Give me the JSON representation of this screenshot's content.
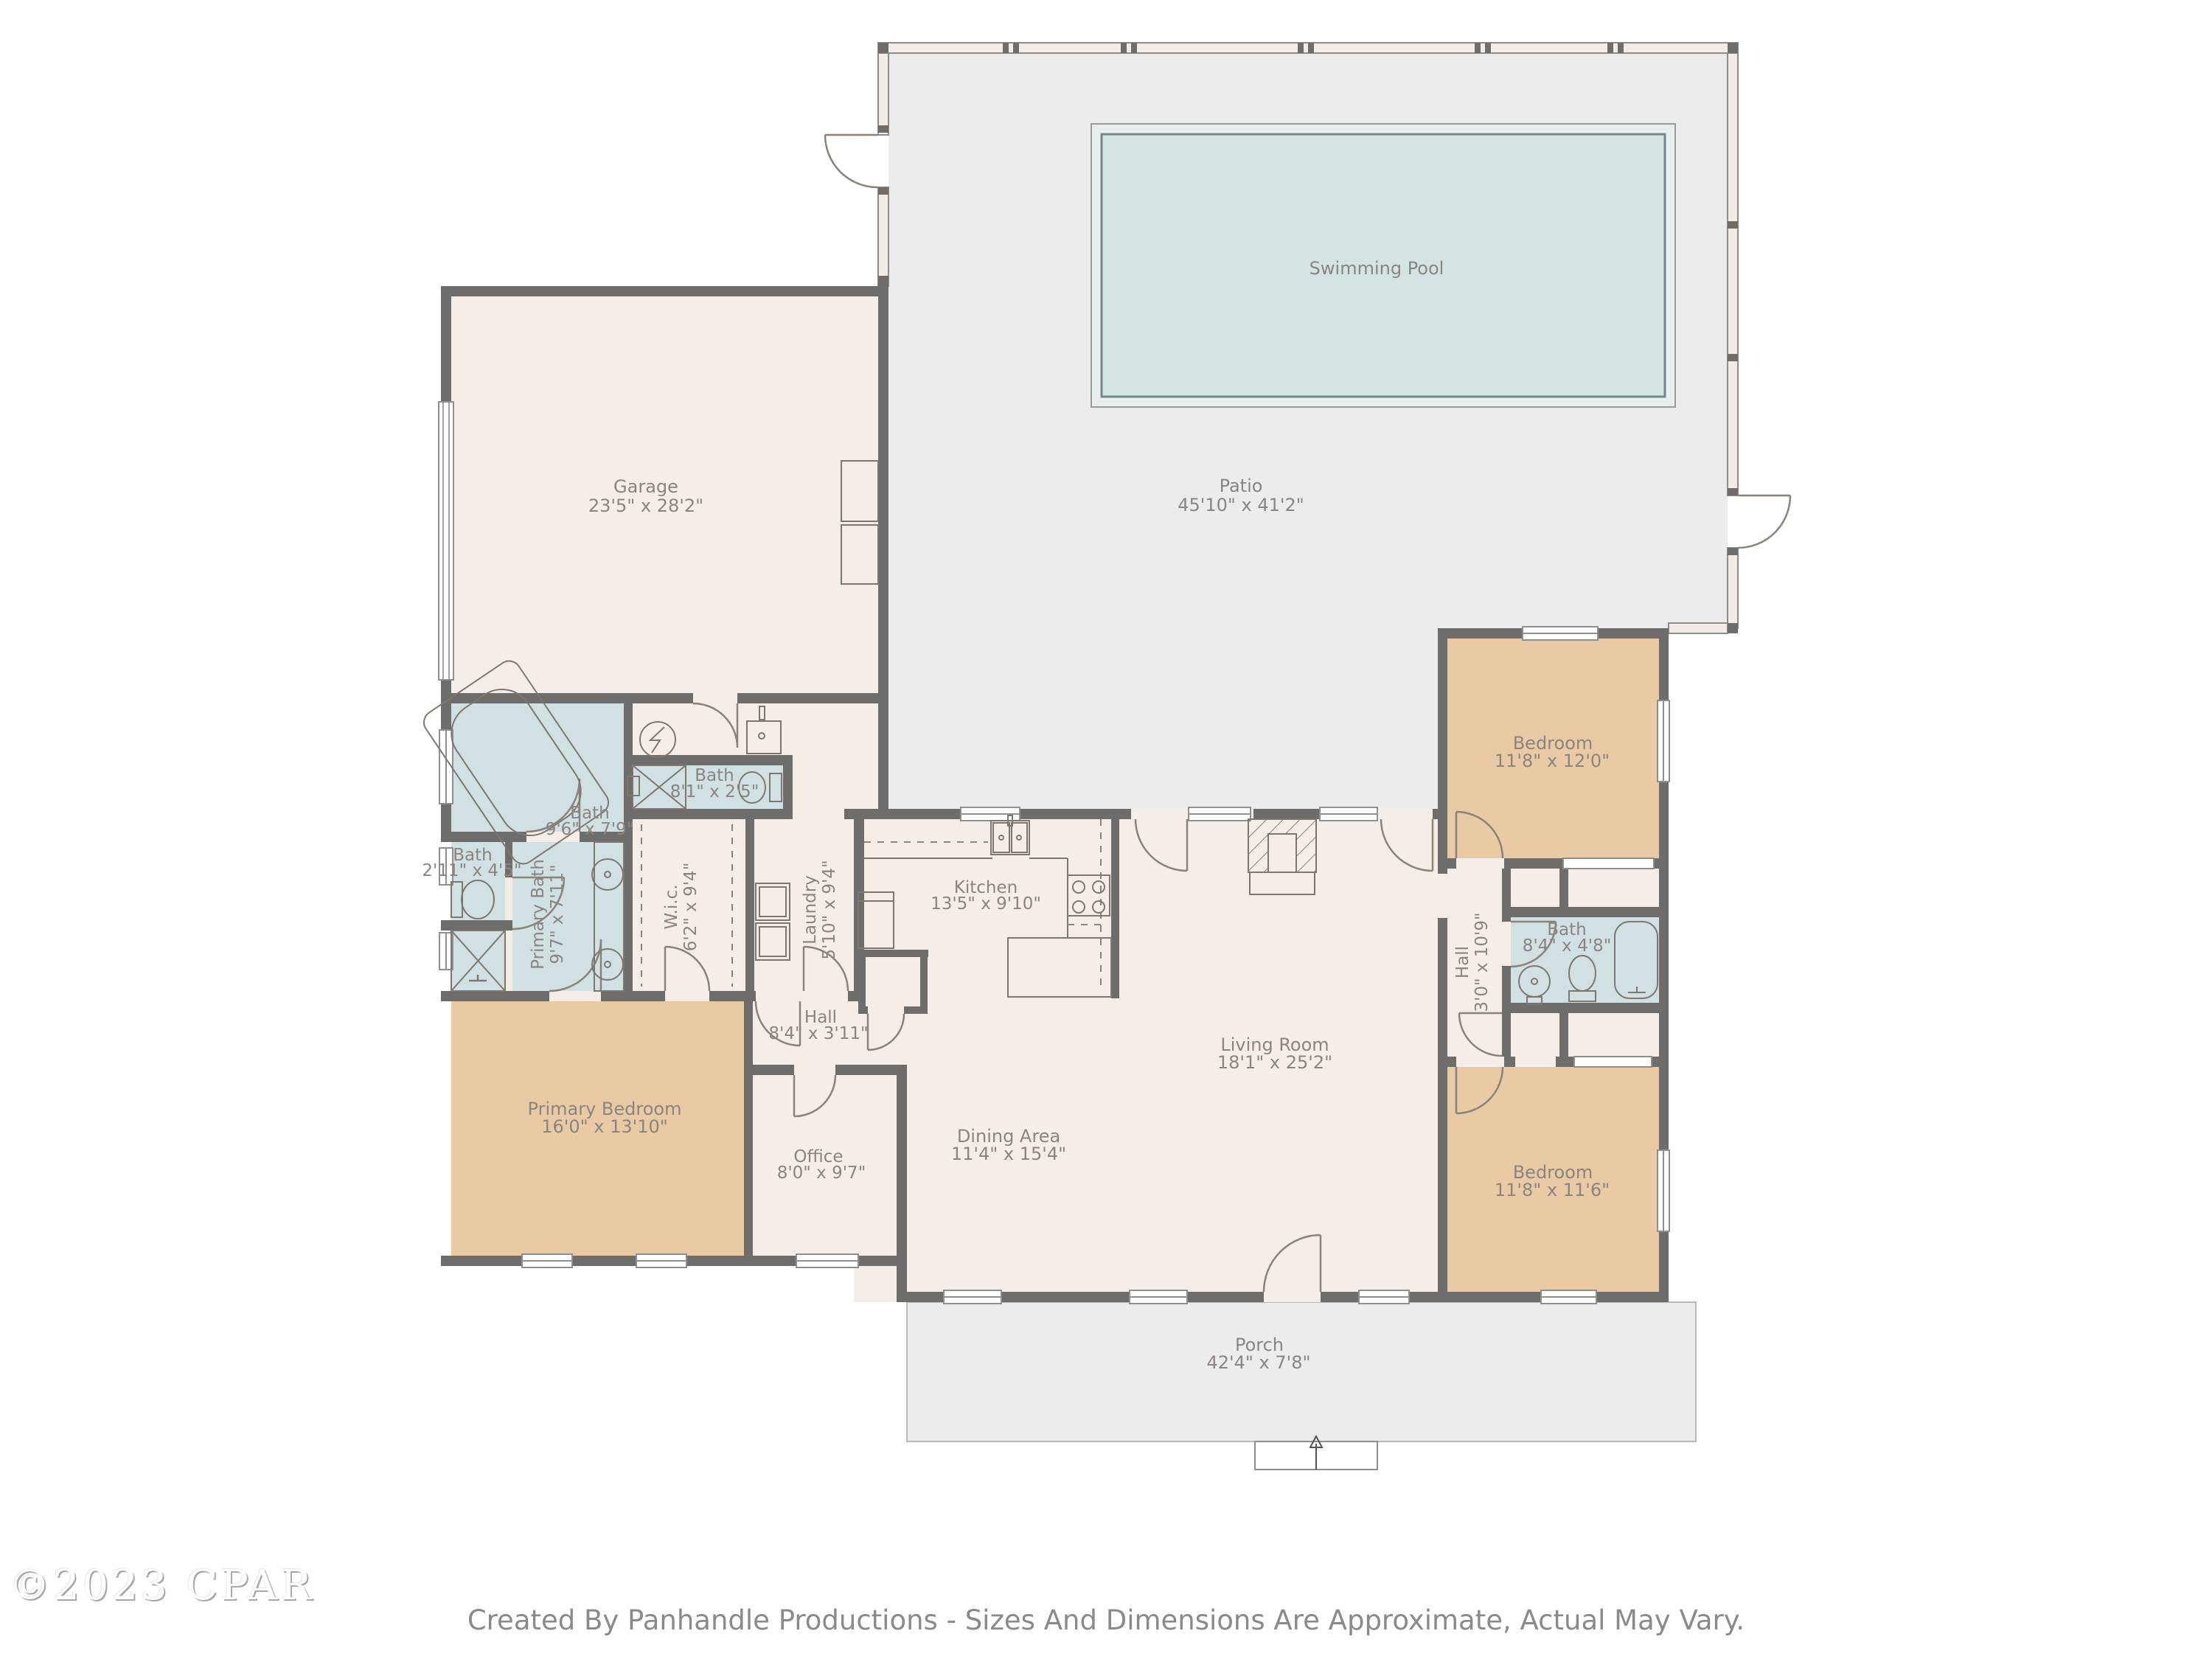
{
  "rooms": {
    "pool": {
      "name": "Swimming Pool",
      "dims": ""
    },
    "patio": {
      "name": "Patio",
      "dims": "45'10\" x 41'2\""
    },
    "garage": {
      "name": "Garage",
      "dims": "23'5\" x 28'2\""
    },
    "bath_main": {
      "name": "Bath",
      "dims": "9'6\" x 7'9\""
    },
    "bath_garage": {
      "name": "Bath",
      "dims": "8'1\" x 2'5\""
    },
    "bath_small": {
      "name": "Bath",
      "dims": "2'11\" x 4'5\""
    },
    "primary_bath": {
      "name": "Primary Bath",
      "dims": "9'7\" x 7'11\""
    },
    "wic": {
      "name": "W.i.c.",
      "dims": "6'2\" x 9'4\""
    },
    "laundry": {
      "name": "Laundry",
      "dims": "5'10\" x 9'4\""
    },
    "kitchen": {
      "name": "Kitchen",
      "dims": "13'5\" x 9'10\""
    },
    "hall": {
      "name": "Hall",
      "dims": "8'4\" x 3'11\""
    },
    "office": {
      "name": "Office",
      "dims": "8'0\" x 9'7\""
    },
    "dining": {
      "name": "Dining Area",
      "dims": "11'4\" x 15'4\""
    },
    "living": {
      "name": "Living Room",
      "dims": "18'1\" x 25'2\""
    },
    "primary_bedroom": {
      "name": "Primary Bedroom",
      "dims": "16'0\" x 13'10\""
    },
    "bedroom_top": {
      "name": "Bedroom",
      "dims": "11'8\" x 12'0\""
    },
    "hall_bedrooms": {
      "name": "Hall",
      "dims": "3'0\" x 10'9\""
    },
    "bath_hall": {
      "name": "Bath",
      "dims": "8'4\" x 4'8\""
    },
    "bedroom_bottom": {
      "name": "Bedroom",
      "dims": "11'8\" x 11'6\""
    },
    "porch": {
      "name": "Porch",
      "dims": "42'4\" x 7'8\""
    }
  },
  "watermark": "©2023 CPAR",
  "footer": "Created By Panhandle Productions - Sizes And Dimensions Are Approximate, Actual May Vary.",
  "colors": {
    "wall": "#6e6d6b",
    "interior": "#f5ede8",
    "bedroom": "#eac9a5",
    "bath": "#d0e0e3",
    "outdoor": "#ececec",
    "pool_water": "#d4e3e3",
    "label_text": "#8b8580"
  }
}
